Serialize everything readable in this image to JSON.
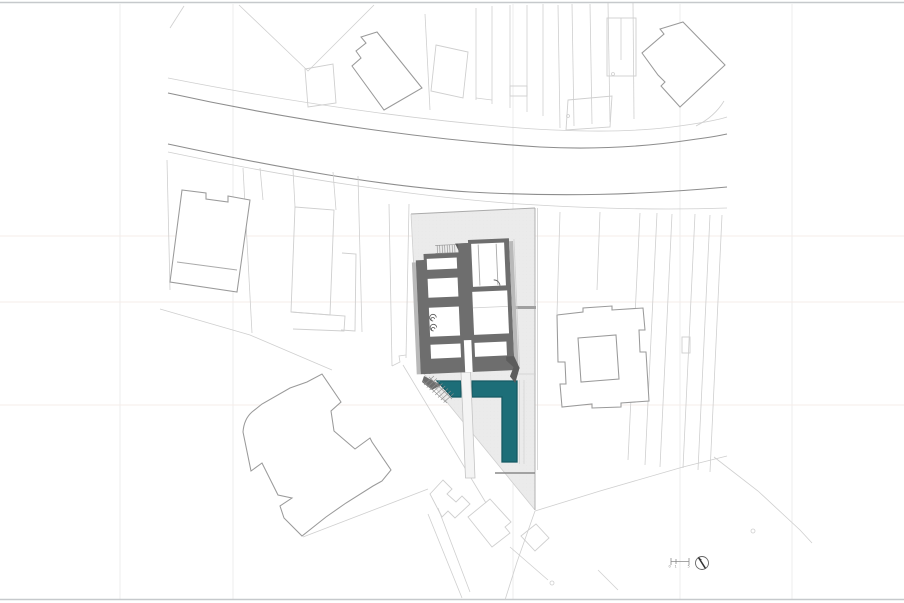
{
  "drawing": {
    "title": "architectural-site-plan",
    "scale_bar": {
      "labels": [
        "0",
        "1",
        "5"
      ]
    },
    "north_arrow": {
      "type": "circle-with-needle"
    }
  },
  "colors": {
    "water": "#1d6e78",
    "water_dark": "#155a63",
    "site_fill": "#ebebeb",
    "wall": "#6e6e6e",
    "wall_dark": "#5c5c5c",
    "wall_face": "#b9b9b9",
    "line_light": "#cfcfcf",
    "line_medium": "#aaaaaa",
    "line_dark": "#8d8d8d",
    "outline_building": "#9a9a9a",
    "border": "#c6c9cc",
    "guide_v": "#ececec",
    "guide_h": "#f6ece8",
    "deck": "#d8d8d8",
    "text": "#888888"
  }
}
